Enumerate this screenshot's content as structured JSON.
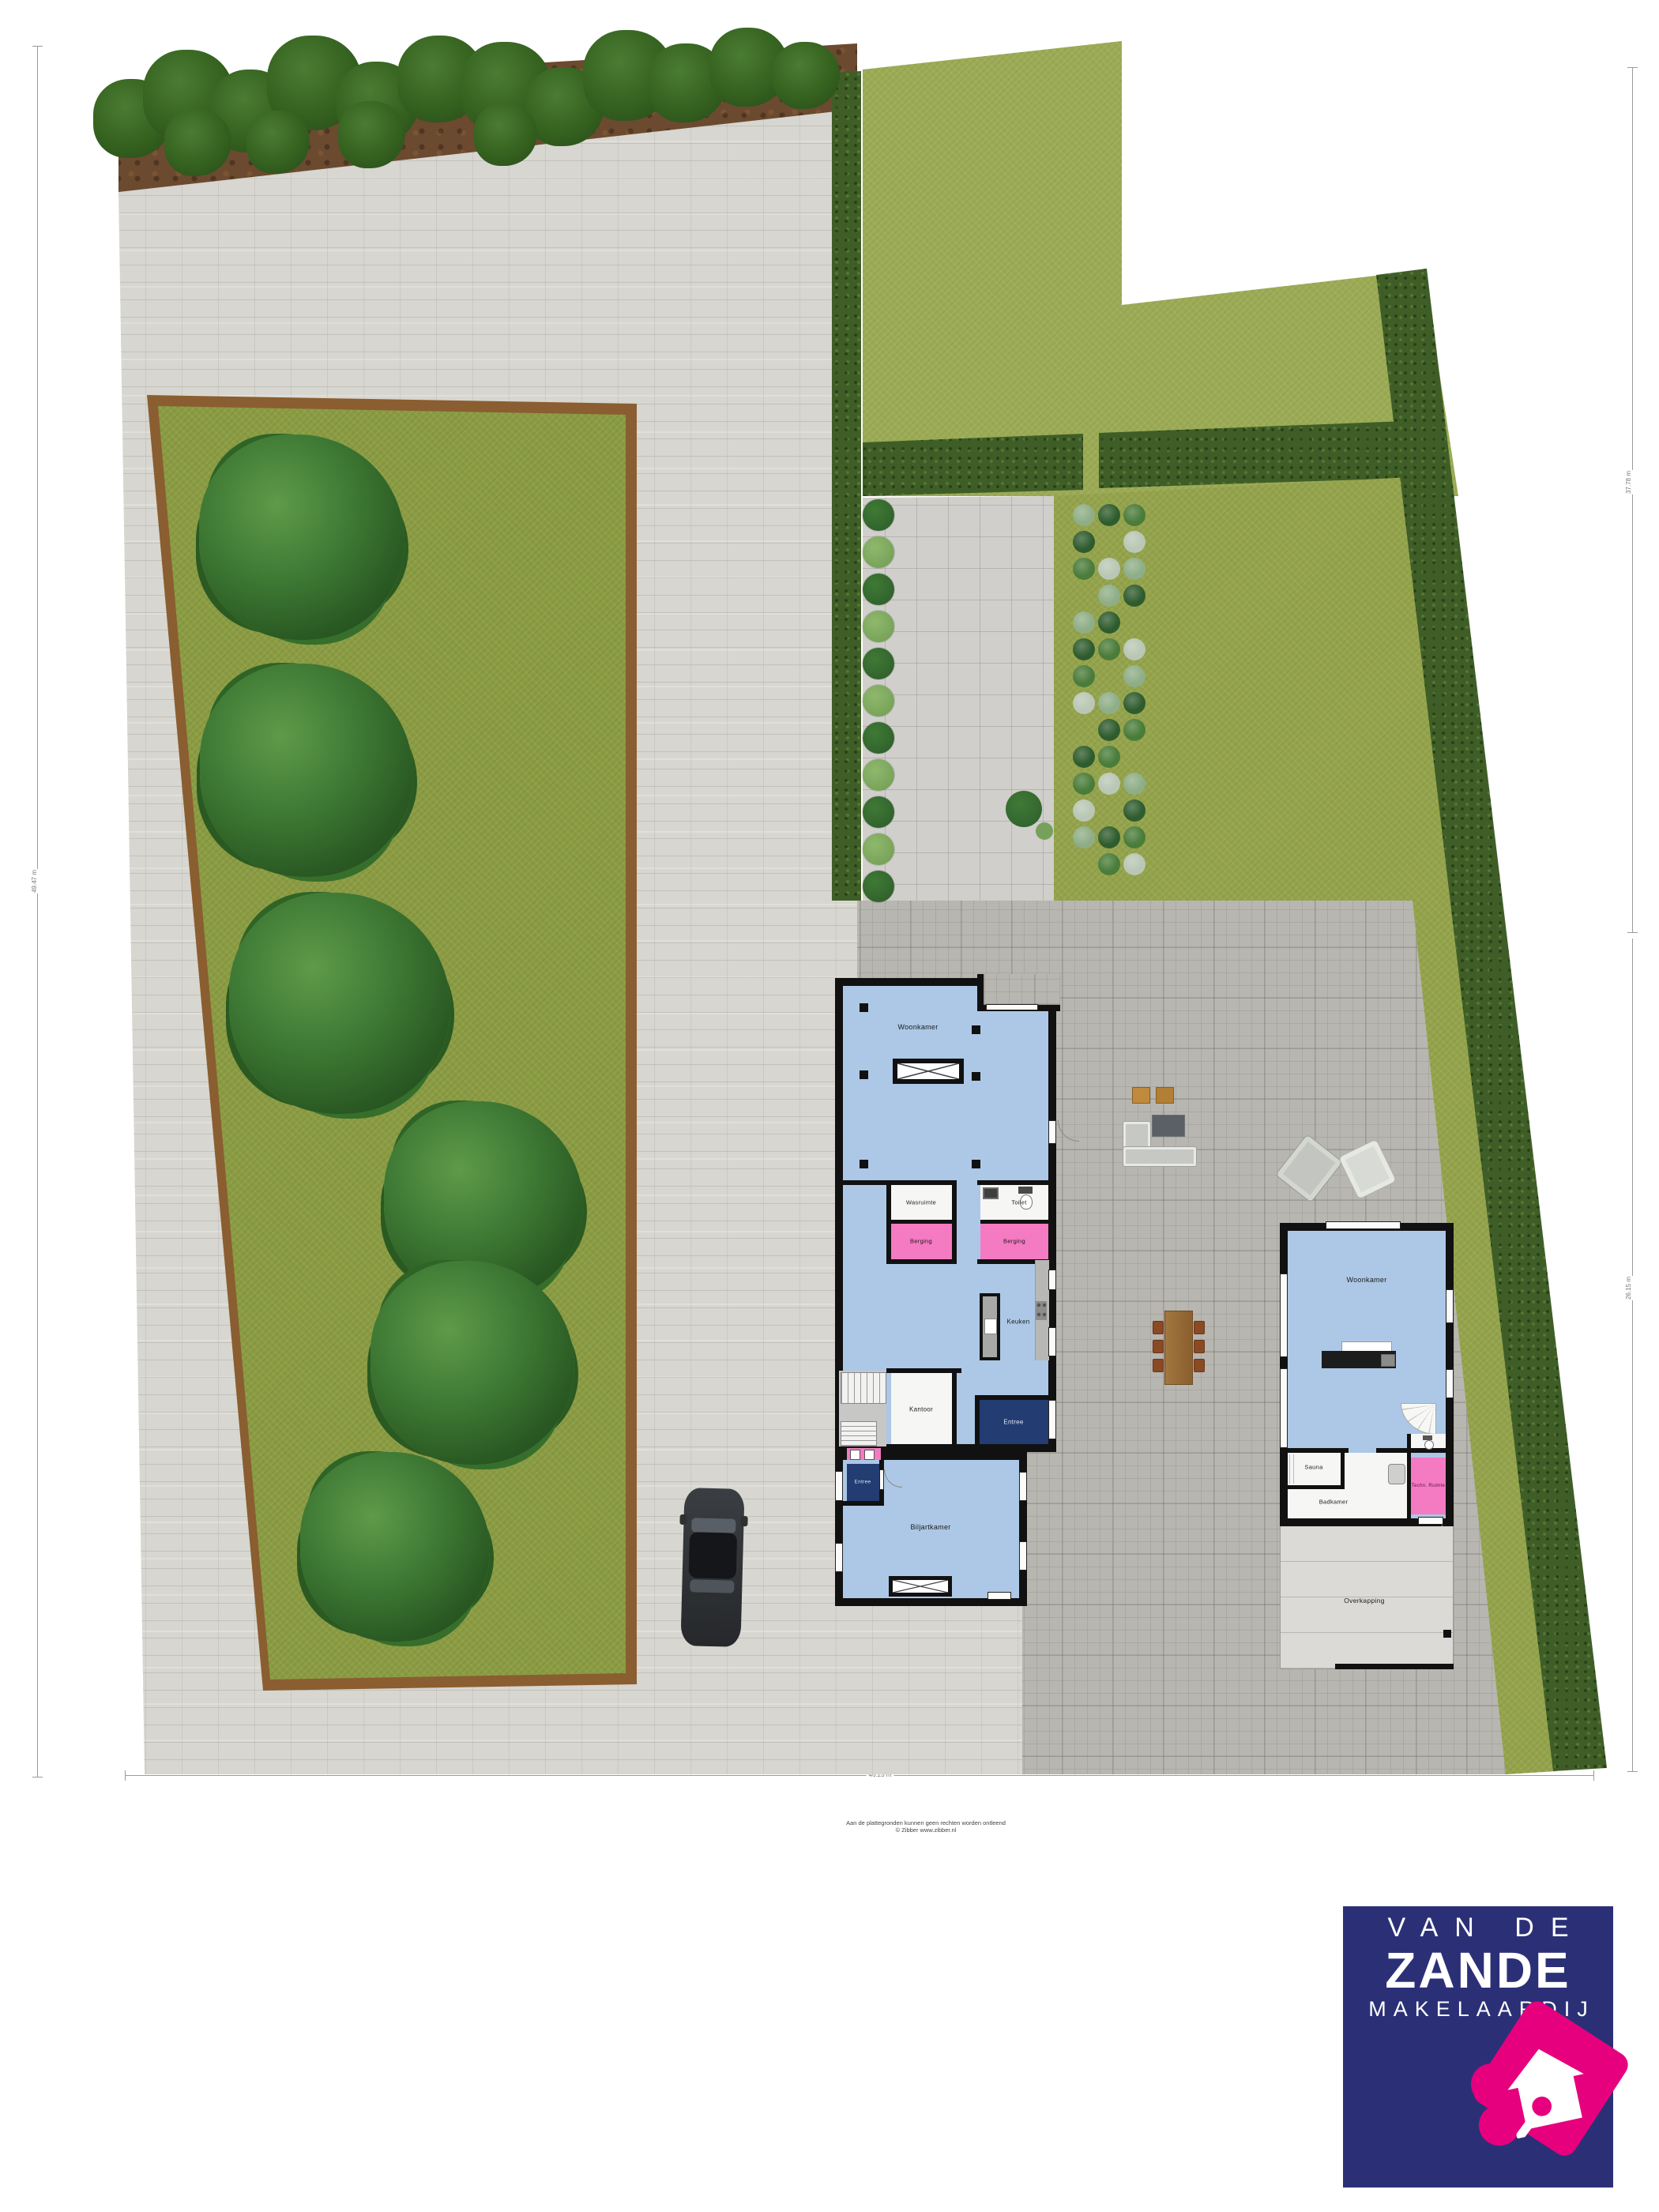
{
  "labels": {
    "main_house": {
      "woonkamer": "Woonkamer",
      "wasruimte": "Wasruimte",
      "toilet": "Toilet",
      "berging_left": "Berging",
      "berging_right": "Berging",
      "keuken": "Keuken",
      "kantoor": "Kantoor",
      "entree": "Entree",
      "entree_side": "Entree",
      "biljartkamer": "Biljartkamer"
    },
    "guest_house": {
      "woonkamer": "Woonkamer",
      "sauna": "Sauna",
      "badkamer": "Badkamer",
      "techn_ruimte": "Techn. Ruimte",
      "overkapping": "Overkapping"
    }
  },
  "dimensions": {
    "left": "49.47 m",
    "bottom": "46.23 m",
    "right_top": "37.78 m",
    "right_bottom": "26.15 m"
  },
  "footer": {
    "disclaimer_line1": "Aan de plattegronden kunnen geen rechten worden ontleend",
    "disclaimer_line2": "© Zibber www.zibber.nl"
  },
  "logo": {
    "line1": "VAN DE",
    "line2": "ZANDE",
    "line3": "MAKELAARDIJ"
  },
  "colors": {
    "room_blue": "#adc8e6",
    "room_pink": "#f47ac1",
    "entree_navy": "#233c72",
    "wall": "#111111",
    "logo_navy": "#2b3076",
    "logo_pink": "#e6007e",
    "grass": "#9cab55",
    "lawn": "#8b9c43",
    "hedge": "#3f5e27"
  }
}
